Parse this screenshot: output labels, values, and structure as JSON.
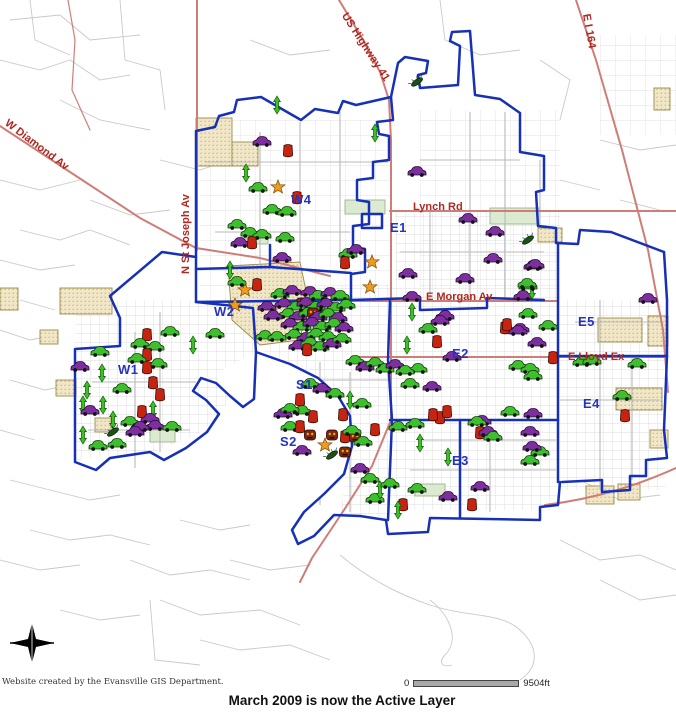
{
  "footer": {
    "credit": "Website created by the Evansville GIS Department.",
    "status_message": "March 2009 is now the Active Layer",
    "scale": {
      "zero_label": "0",
      "distance_label": "9504ft"
    }
  },
  "map": {
    "colors": {
      "boundary": "#1630b8",
      "highway": "#cf7d78",
      "road": "#c9c9c9",
      "district_label": "#2433c0",
      "street_label": "#b02820",
      "tan_border": "#9b8a49",
      "scalebar": "#a8a8a8",
      "title_text": "#111111",
      "credit_text": "#333333",
      "marker_green": "#3dbf2e",
      "marker_purple": "#7d2fa0",
      "marker_red": "#c62310",
      "marker_mask": "#7e2812",
      "marker_star": "#f29a1f",
      "marker_arrow": "#39c223",
      "marker_bug": "#1d4f16"
    },
    "district_labels": [
      {
        "text": "W1",
        "x": 118,
        "y": 362
      },
      {
        "text": "W2",
        "x": 214,
        "y": 304
      },
      {
        "text": "W4",
        "x": 291,
        "y": 192
      },
      {
        "text": "S1",
        "x": 296,
        "y": 377
      },
      {
        "text": "S2",
        "x": 280,
        "y": 434
      },
      {
        "text": "E1",
        "x": 390,
        "y": 220
      },
      {
        "text": "E2",
        "x": 452,
        "y": 346
      },
      {
        "text": "E3",
        "x": 452,
        "y": 453
      },
      {
        "text": "E4",
        "x": 583,
        "y": 396
      },
      {
        "text": "E5",
        "x": 578,
        "y": 314
      }
    ],
    "street_labels": [
      {
        "text": "W Diamond Av",
        "x": 6,
        "y": 116,
        "rot": 37
      },
      {
        "text": "N St Joseph Av",
        "x": 186,
        "y": 268,
        "rot": -90
      },
      {
        "text": "US Highway 41",
        "x": 344,
        "y": 8,
        "rot": 57
      },
      {
        "text": "E I 164",
        "x": 586,
        "y": 8,
        "rot": 80
      },
      {
        "text": "Lynch Rd",
        "x": 413,
        "y": 201,
        "rot": 0
      },
      {
        "text": "E Morgan Av",
        "x": 426,
        "y": 291,
        "rot": 0
      },
      {
        "text": "E Lloyd Ex",
        "x": 568,
        "y": 351,
        "rot": 0
      }
    ],
    "marker_types": {
      "gc": {
        "name": "green-car-marker",
        "color": "#3dbf2e"
      },
      "pc": {
        "name": "purple-car-marker",
        "color": "#7d2fa0"
      },
      "rb": {
        "name": "red-blob-marker",
        "color": "#c62310"
      },
      "mk": {
        "name": "mask-marker",
        "color": "#7e2812"
      },
      "st": {
        "name": "star-marker",
        "color": "#f29a1f"
      },
      "ar": {
        "name": "green-arrow-marker",
        "color": "#39c223"
      },
      "bg": {
        "name": "bug-marker",
        "color": "#1d4f16"
      }
    },
    "markers": [
      [
        "ar",
        277,
        105
      ],
      [
        "pc",
        262,
        143
      ],
      [
        "rb",
        288,
        151
      ],
      [
        "ar",
        375,
        133
      ],
      [
        "ar",
        246,
        173
      ],
      [
        "gc",
        258,
        189
      ],
      [
        "st",
        278,
        187
      ],
      [
        "rb",
        297,
        198
      ],
      [
        "gc",
        272,
        211
      ],
      [
        "gc",
        287,
        213
      ],
      [
        "gc",
        237,
        226
      ],
      [
        "gc",
        250,
        234
      ],
      [
        "gc",
        262,
        236
      ],
      [
        "gc",
        285,
        239
      ],
      [
        "pc",
        240,
        244
      ],
      [
        "pc",
        282,
        259
      ],
      [
        "gc",
        348,
        255
      ],
      [
        "pc",
        356,
        251
      ],
      [
        "rb",
        345,
        263
      ],
      [
        "st",
        372,
        262
      ],
      [
        "bg",
        417,
        82
      ],
      [
        "pc",
        417,
        173
      ],
      [
        "pc",
        468,
        220
      ],
      [
        "pc",
        495,
        233
      ],
      [
        "pc",
        493,
        260
      ],
      [
        "bg",
        528,
        240
      ],
      [
        "pc",
        533,
        267
      ],
      [
        "pc",
        465,
        280
      ],
      [
        "pc",
        412,
        298
      ],
      [
        "pc",
        523,
        297
      ],
      [
        "ar",
        532,
        290
      ],
      [
        "gc",
        528,
        287
      ],
      [
        "pc",
        535,
        266
      ],
      [
        "gc",
        528,
        315
      ],
      [
        "gc",
        548,
        327
      ],
      [
        "pc",
        520,
        330
      ],
      [
        "pc",
        537,
        344
      ],
      [
        "rb",
        505,
        328
      ],
      [
        "rb",
        553,
        358
      ],
      [
        "gc",
        582,
        363
      ],
      [
        "gc",
        592,
        362
      ],
      [
        "gc",
        637,
        365
      ],
      [
        "pc",
        648,
        300
      ],
      [
        "rb",
        625,
        416
      ],
      [
        "gc",
        622,
        397
      ],
      [
        "gc",
        540,
        453
      ],
      [
        "pc",
        408,
        275
      ],
      [
        "ar",
        412,
        312
      ],
      [
        "gc",
        428,
        330
      ],
      [
        "ar",
        407,
        345
      ],
      [
        "pc",
        445,
        317
      ],
      [
        "pc",
        440,
        322
      ],
      [
        "rb",
        437,
        342
      ],
      [
        "rb",
        507,
        325
      ],
      [
        "pc",
        452,
        358
      ],
      [
        "pc",
        518,
        332
      ],
      [
        "gc",
        518,
        367
      ],
      [
        "gc",
        530,
        370
      ],
      [
        "gc",
        533,
        377
      ],
      [
        "gc",
        527,
        285
      ],
      [
        "gc",
        410,
        385
      ],
      [
        "gc",
        418,
        370
      ],
      [
        "pc",
        432,
        388
      ],
      [
        "rb",
        440,
        418
      ],
      [
        "pc",
        482,
        422
      ],
      [
        "rb",
        447,
        412
      ],
      [
        "pc",
        283,
        415
      ],
      [
        "gc",
        302,
        412
      ],
      [
        "rb",
        313,
        417
      ],
      [
        "rb",
        343,
        415
      ],
      [
        "gc",
        290,
        428
      ],
      [
        "rb",
        300,
        427
      ],
      [
        "mk",
        310,
        435
      ],
      [
        "mk",
        332,
        435
      ],
      [
        "rb",
        345,
        437
      ],
      [
        "mk",
        355,
        437
      ],
      [
        "gc",
        363,
        443
      ],
      [
        "rb",
        375,
        430
      ],
      [
        "gc",
        398,
        428
      ],
      [
        "gc",
        415,
        425
      ],
      [
        "rb",
        433,
        415
      ],
      [
        "ar",
        420,
        443
      ],
      [
        "ar",
        448,
        457
      ],
      [
        "gc",
        477,
        423
      ],
      [
        "rb",
        480,
        433
      ],
      [
        "pc",
        488,
        433
      ],
      [
        "gc",
        493,
        438
      ],
      [
        "gc",
        510,
        413
      ],
      [
        "pc",
        533,
        415
      ],
      [
        "pc",
        530,
        433
      ],
      [
        "pc",
        532,
        448
      ],
      [
        "gc",
        530,
        462
      ],
      [
        "pc",
        480,
        488
      ],
      [
        "pc",
        448,
        498
      ],
      [
        "rb",
        403,
        505
      ],
      [
        "rb",
        472,
        505
      ],
      [
        "gc",
        375,
        500
      ],
      [
        "ar",
        398,
        510
      ],
      [
        "mk",
        345,
        452
      ],
      [
        "pc",
        302,
        452
      ],
      [
        "st",
        325,
        445
      ],
      [
        "bg",
        332,
        455
      ],
      [
        "gc",
        352,
        432
      ],
      [
        "gc",
        417,
        490
      ],
      [
        "gc",
        280,
        295
      ],
      [
        "pc",
        292,
        292
      ],
      [
        "mk",
        302,
        303
      ],
      [
        "pc",
        310,
        293
      ],
      [
        "gc",
        318,
        297
      ],
      [
        "pc",
        330,
        294
      ],
      [
        "gc",
        340,
        297
      ],
      [
        "pc",
        284,
        305
      ],
      [
        "gc",
        296,
        308
      ],
      [
        "pc",
        306,
        304
      ],
      [
        "gc",
        316,
        308
      ],
      [
        "pc",
        326,
        305
      ],
      [
        "gc",
        336,
        309
      ],
      [
        "gc",
        346,
        306
      ],
      [
        "gc",
        288,
        315
      ],
      [
        "pc",
        298,
        318
      ],
      [
        "gc",
        308,
        314
      ],
      [
        "mk",
        313,
        313
      ],
      [
        "pc",
        318,
        318
      ],
      [
        "gc",
        328,
        315
      ],
      [
        "pc",
        338,
        319
      ],
      [
        "pc",
        290,
        325
      ],
      [
        "gc",
        302,
        328
      ],
      [
        "pc",
        312,
        324
      ],
      [
        "gc",
        322,
        328
      ],
      [
        "gc",
        334,
        325
      ],
      [
        "pc",
        344,
        329
      ],
      [
        "gc",
        294,
        336
      ],
      [
        "pc",
        306,
        339
      ],
      [
        "gc",
        316,
        335
      ],
      [
        "gc",
        328,
        338
      ],
      [
        "pc",
        298,
        347
      ],
      [
        "gc",
        310,
        344
      ],
      [
        "gc",
        320,
        348
      ],
      [
        "pc",
        332,
        345
      ],
      [
        "gc",
        342,
        340
      ],
      [
        "rb",
        307,
        350
      ],
      [
        "st",
        370,
        287
      ],
      [
        "gc",
        355,
        362
      ],
      [
        "pc",
        365,
        368
      ],
      [
        "gc",
        375,
        364
      ],
      [
        "gc",
        385,
        370
      ],
      [
        "pc",
        395,
        366
      ],
      [
        "gc",
        405,
        372
      ],
      [
        "gc",
        310,
        385
      ],
      [
        "pc",
        322,
        390
      ],
      [
        "gc",
        335,
        395
      ],
      [
        "ar",
        350,
        400
      ],
      [
        "gc",
        362,
        405
      ],
      [
        "rb",
        300,
        400
      ],
      [
        "gc",
        290,
        410
      ],
      [
        "gc",
        370,
        480
      ],
      [
        "ar",
        380,
        490
      ],
      [
        "gc",
        390,
        485
      ],
      [
        "pc",
        360,
        470
      ],
      [
        "st",
        245,
        290
      ],
      [
        "rb",
        257,
        285
      ],
      [
        "gc",
        237,
        283
      ],
      [
        "st",
        235,
        305
      ],
      [
        "pc",
        267,
        308
      ],
      [
        "pc",
        273,
        317
      ],
      [
        "gc",
        265,
        337
      ],
      [
        "gc",
        277,
        338
      ],
      [
        "rb",
        252,
        243
      ],
      [
        "ar",
        230,
        270
      ],
      [
        "rb",
        147,
        335
      ],
      [
        "gc",
        170,
        333
      ],
      [
        "gc",
        215,
        335
      ],
      [
        "gc",
        140,
        345
      ],
      [
        "gc",
        155,
        348
      ],
      [
        "ar",
        193,
        345
      ],
      [
        "rb",
        147,
        355
      ],
      [
        "gc",
        137,
        360
      ],
      [
        "gc",
        158,
        365
      ],
      [
        "rb",
        147,
        368
      ],
      [
        "gc",
        100,
        353
      ],
      [
        "pc",
        80,
        368
      ],
      [
        "ar",
        102,
        373
      ],
      [
        "rb",
        153,
        383
      ],
      [
        "rb",
        160,
        395
      ],
      [
        "ar",
        83,
        405
      ],
      [
        "ar",
        103,
        405
      ],
      [
        "ar",
        113,
        420
      ],
      [
        "rb",
        142,
        412
      ],
      [
        "ar",
        153,
        410
      ],
      [
        "gc",
        130,
        423
      ],
      [
        "pc",
        150,
        420
      ],
      [
        "pc",
        155,
        427
      ],
      [
        "pc",
        140,
        428
      ],
      [
        "pc",
        135,
        433
      ],
      [
        "ar",
        83,
        435
      ],
      [
        "bg",
        113,
        432
      ],
      [
        "gc",
        98,
        447
      ],
      [
        "gc",
        117,
        445
      ],
      [
        "gc",
        122,
        390
      ],
      [
        "ar",
        87,
        390
      ],
      [
        "pc",
        90,
        412
      ],
      [
        "gc",
        172,
        428
      ]
    ]
  }
}
